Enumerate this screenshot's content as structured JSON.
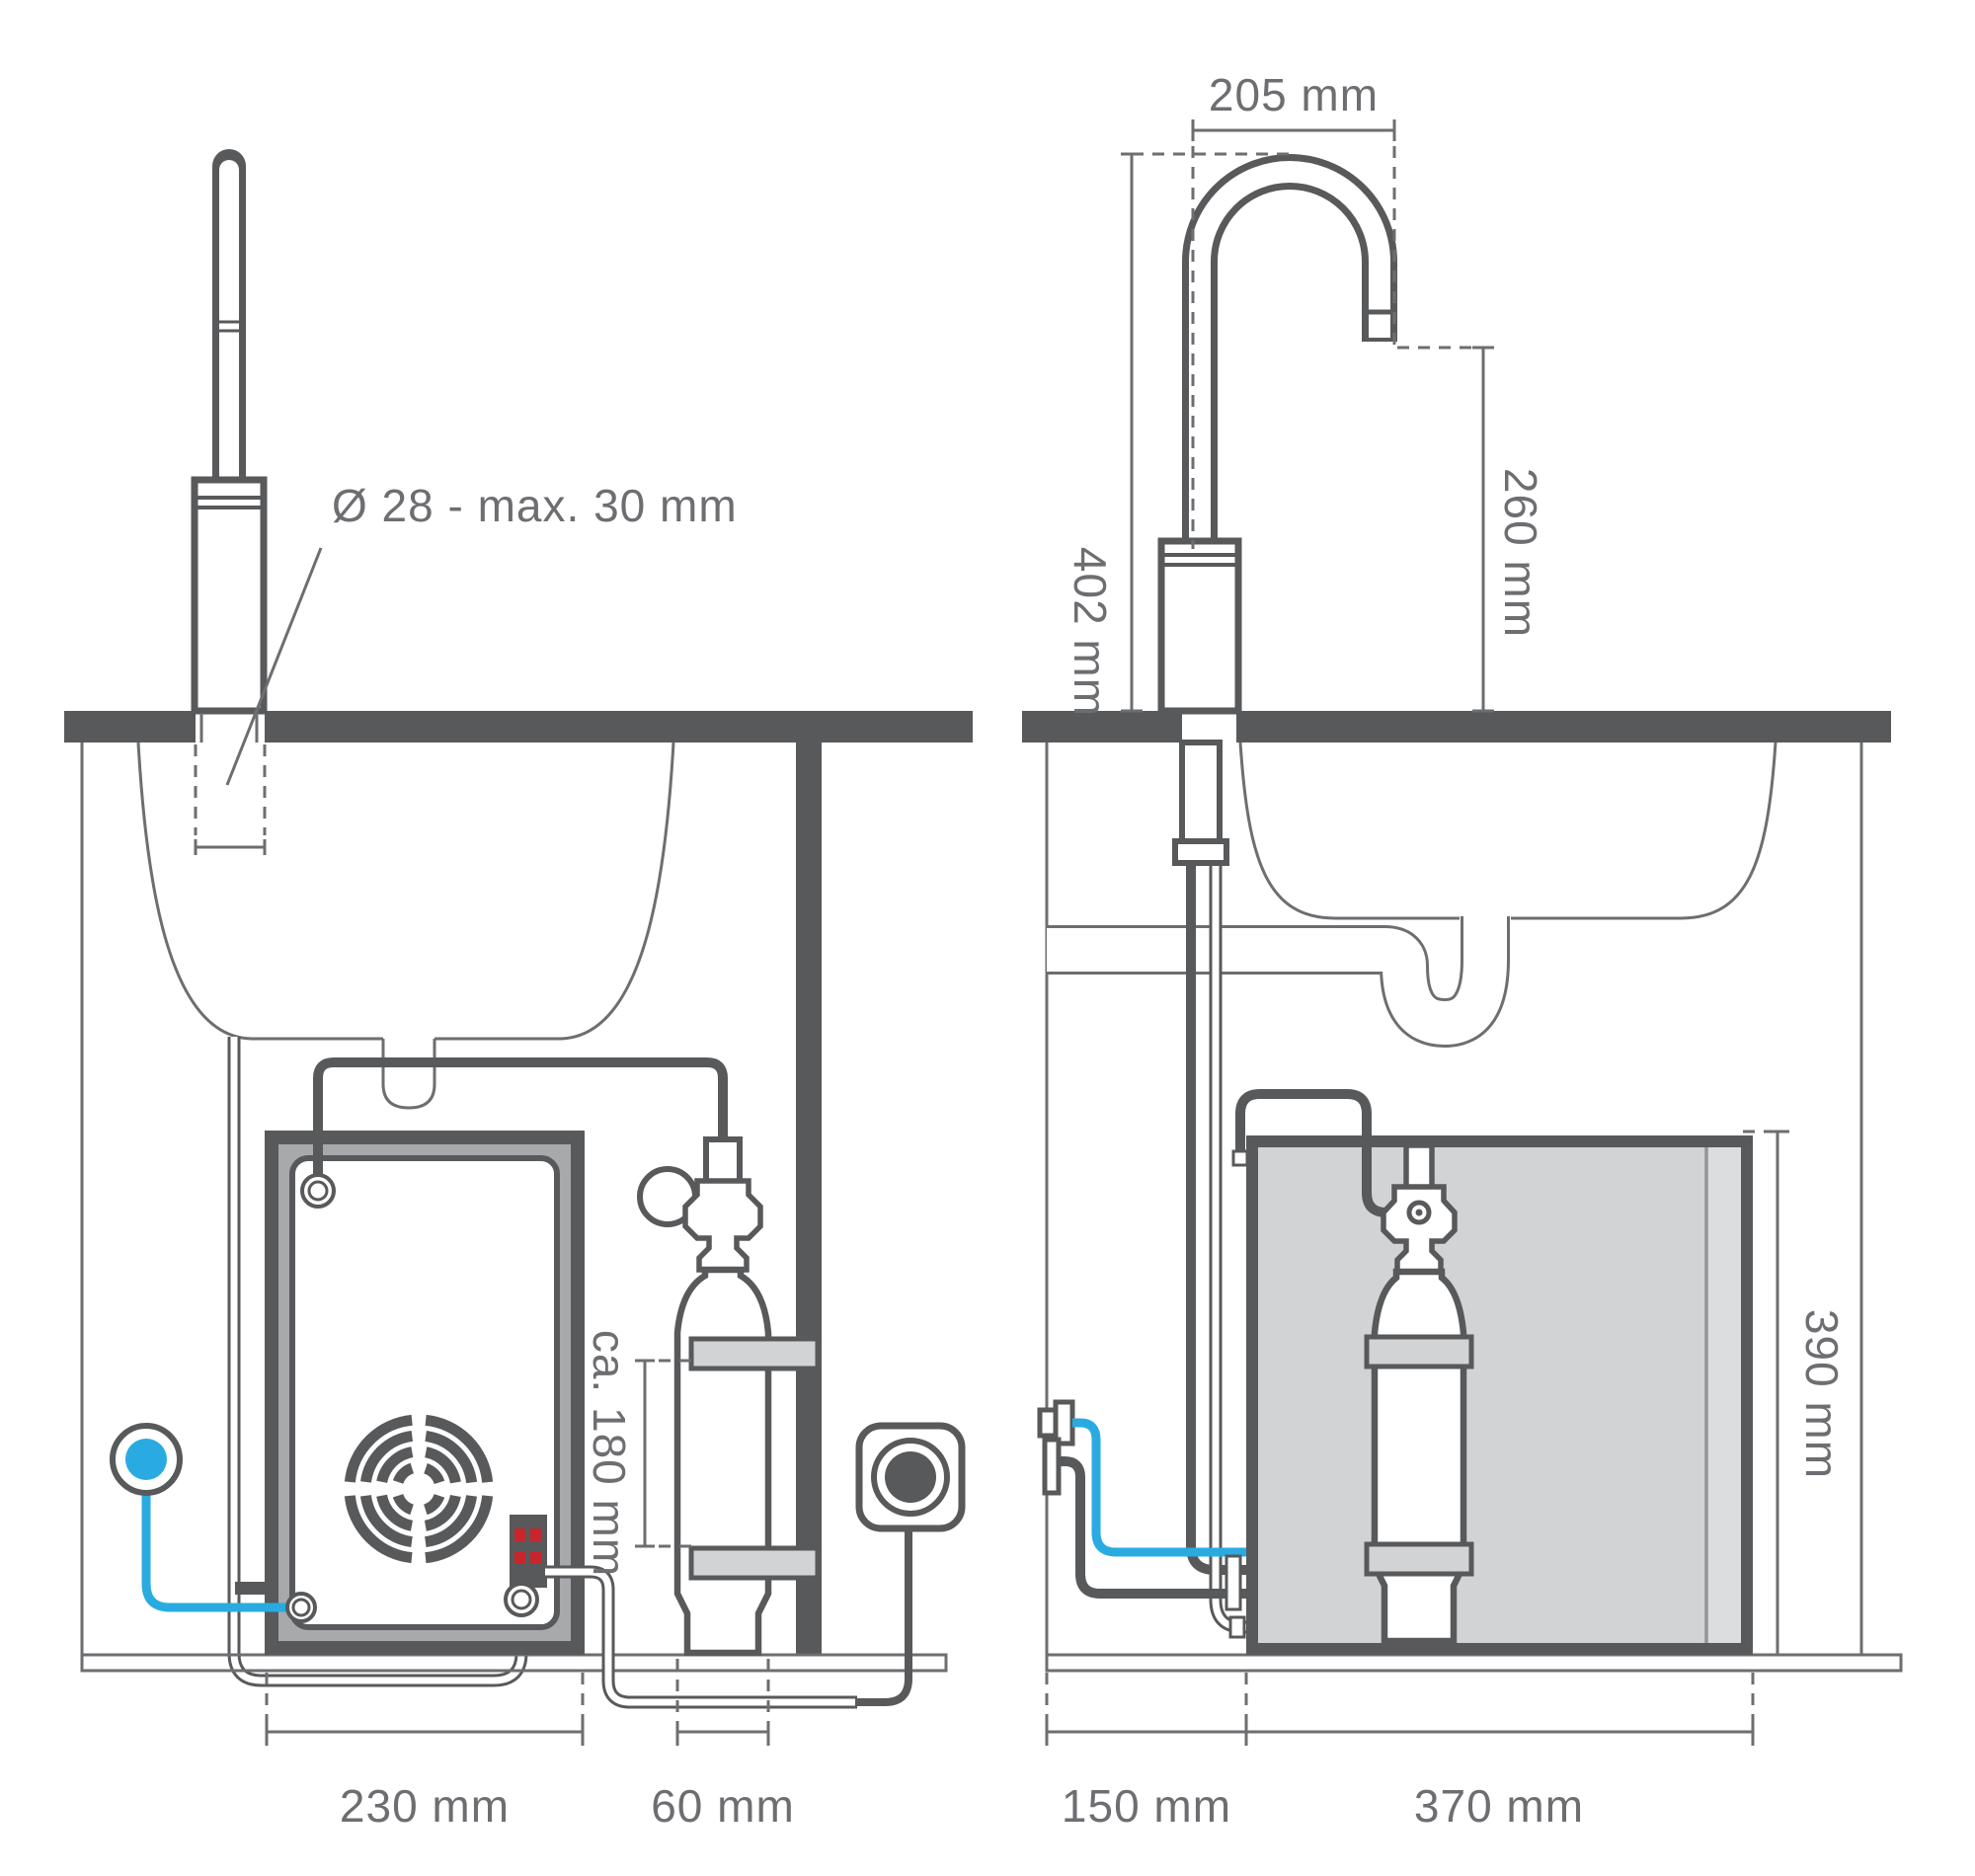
{
  "diagram": {
    "background": "#FFFFFF",
    "colors": {
      "line_dark": "#58595B",
      "line_light": "#6D6E71",
      "frame_gray": "#A7A9AC",
      "panel_gray": "#D1D3D4",
      "panel_gray_light": "#DCDDDE",
      "accent_blue": "#29ABE2",
      "led_red": "#C9252C",
      "text": "#6D6E71"
    },
    "left_view": {
      "labels": {
        "tap_hole": "Ø 28 - max. 30 mm",
        "cylinder_clamp_distance": "ca. 180 mm",
        "unit_width": "230 mm",
        "cylinder_width": "60 mm"
      }
    },
    "right_view": {
      "labels": {
        "spout_reach": "205 mm",
        "tap_height": "402 mm",
        "spout_height": "260 mm",
        "unit_height": "390 mm",
        "side_clearance": "150 mm",
        "unit_depth": "370 mm"
      }
    }
  }
}
